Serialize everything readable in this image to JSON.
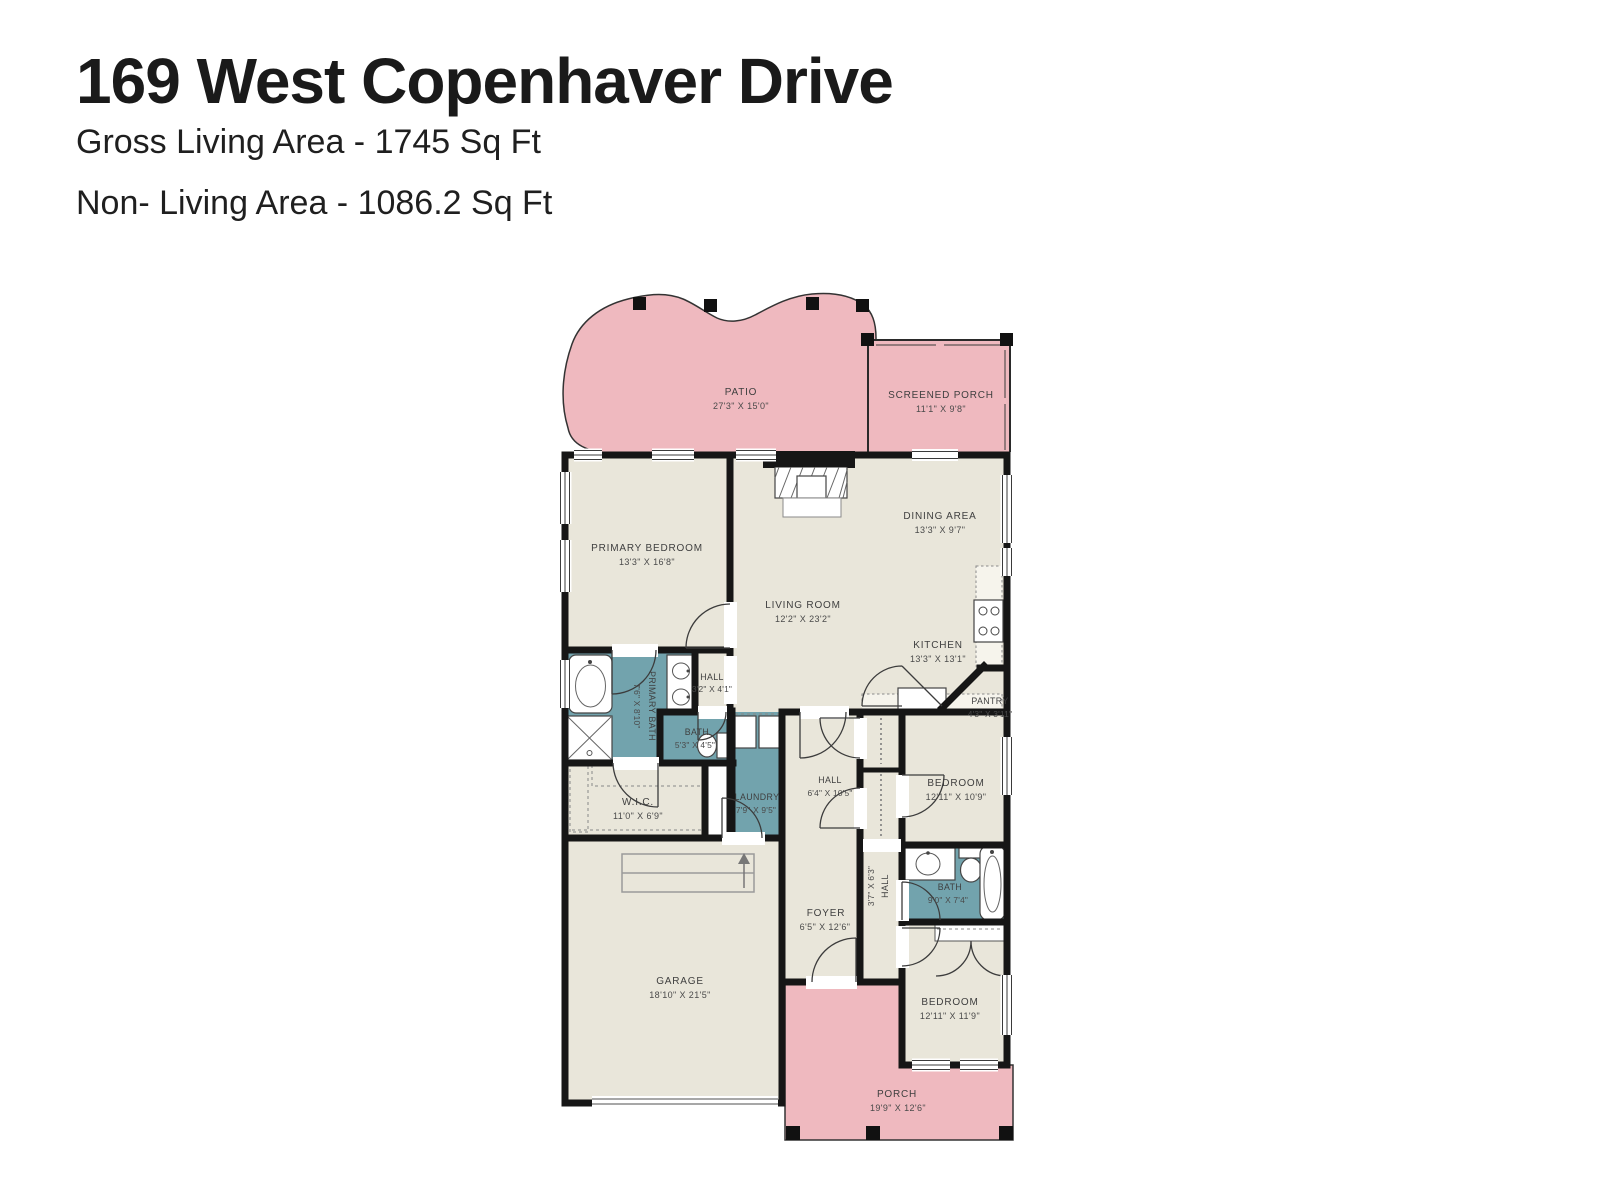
{
  "header": {
    "title": "169 West Copenhaver Drive",
    "gross_living": "Gross Living Area - 1745 Sq Ft",
    "non_living": "Non- Living Area - 1086.2 Sq Ft"
  },
  "colors": {
    "room_fill": "#e9e6da",
    "wet_room_fill": "#72a3ad",
    "outdoor_fill": "#efb9bf",
    "wall": "#161616",
    "label_text": "#3f3f3f"
  },
  "rooms": {
    "patio": {
      "name": "PATIO",
      "dims": "27'3\" X 15'0\""
    },
    "screened_porch": {
      "name": "SCREENED PORCH",
      "dims": "11'1\" X 9'8\""
    },
    "primary_bedroom": {
      "name": "PRIMARY BEDROOM",
      "dims": "13'3\" X 16'8\""
    },
    "dining_area": {
      "name": "DINING AREA",
      "dims": "13'3\" X 9'7\""
    },
    "living_room": {
      "name": "LIVING ROOM",
      "dims": "12'2\" X 23'2\""
    },
    "kitchen": {
      "name": "KITCHEN",
      "dims": "13'3\" X 13'1\""
    },
    "pantry": {
      "name": "PANTRY",
      "dims": "4'3\" X 3'11\""
    },
    "hall_small": {
      "name": "HALL",
      "dims": "3'2\" X 4'1\""
    },
    "primary_bath": {
      "name": "PRIMARY BATH",
      "dims": "7'6\" X 8'10\""
    },
    "bath_small": {
      "name": "BATH",
      "dims": "5'3\" X 4'5\""
    },
    "wic": {
      "name": "W.I.C.",
      "dims": "11'0\" X 6'9\""
    },
    "laundry": {
      "name": "LAUNDRY",
      "dims": "7'9\" X 9'5\""
    },
    "hall_center": {
      "name": "HALL",
      "dims": "6'4\" X 10'5\""
    },
    "bedroom_upper": {
      "name": "BEDROOM",
      "dims": "12'11\" X 10'9\""
    },
    "hall_lower": {
      "name": "HALL",
      "dims": "3'7\" X 6'3\""
    },
    "bath_lower": {
      "name": "BATH",
      "dims": "9'0\" X 7'4\""
    },
    "foyer": {
      "name": "FOYER",
      "dims": "6'5\" X 12'6\""
    },
    "garage": {
      "name": "GARAGE",
      "dims": "18'10\" X 21'5\""
    },
    "bedroom_lower": {
      "name": "BEDROOM",
      "dims": "12'11\" X 11'9\""
    },
    "porch": {
      "name": "PORCH",
      "dims": "19'9\" X 12'6\""
    }
  }
}
